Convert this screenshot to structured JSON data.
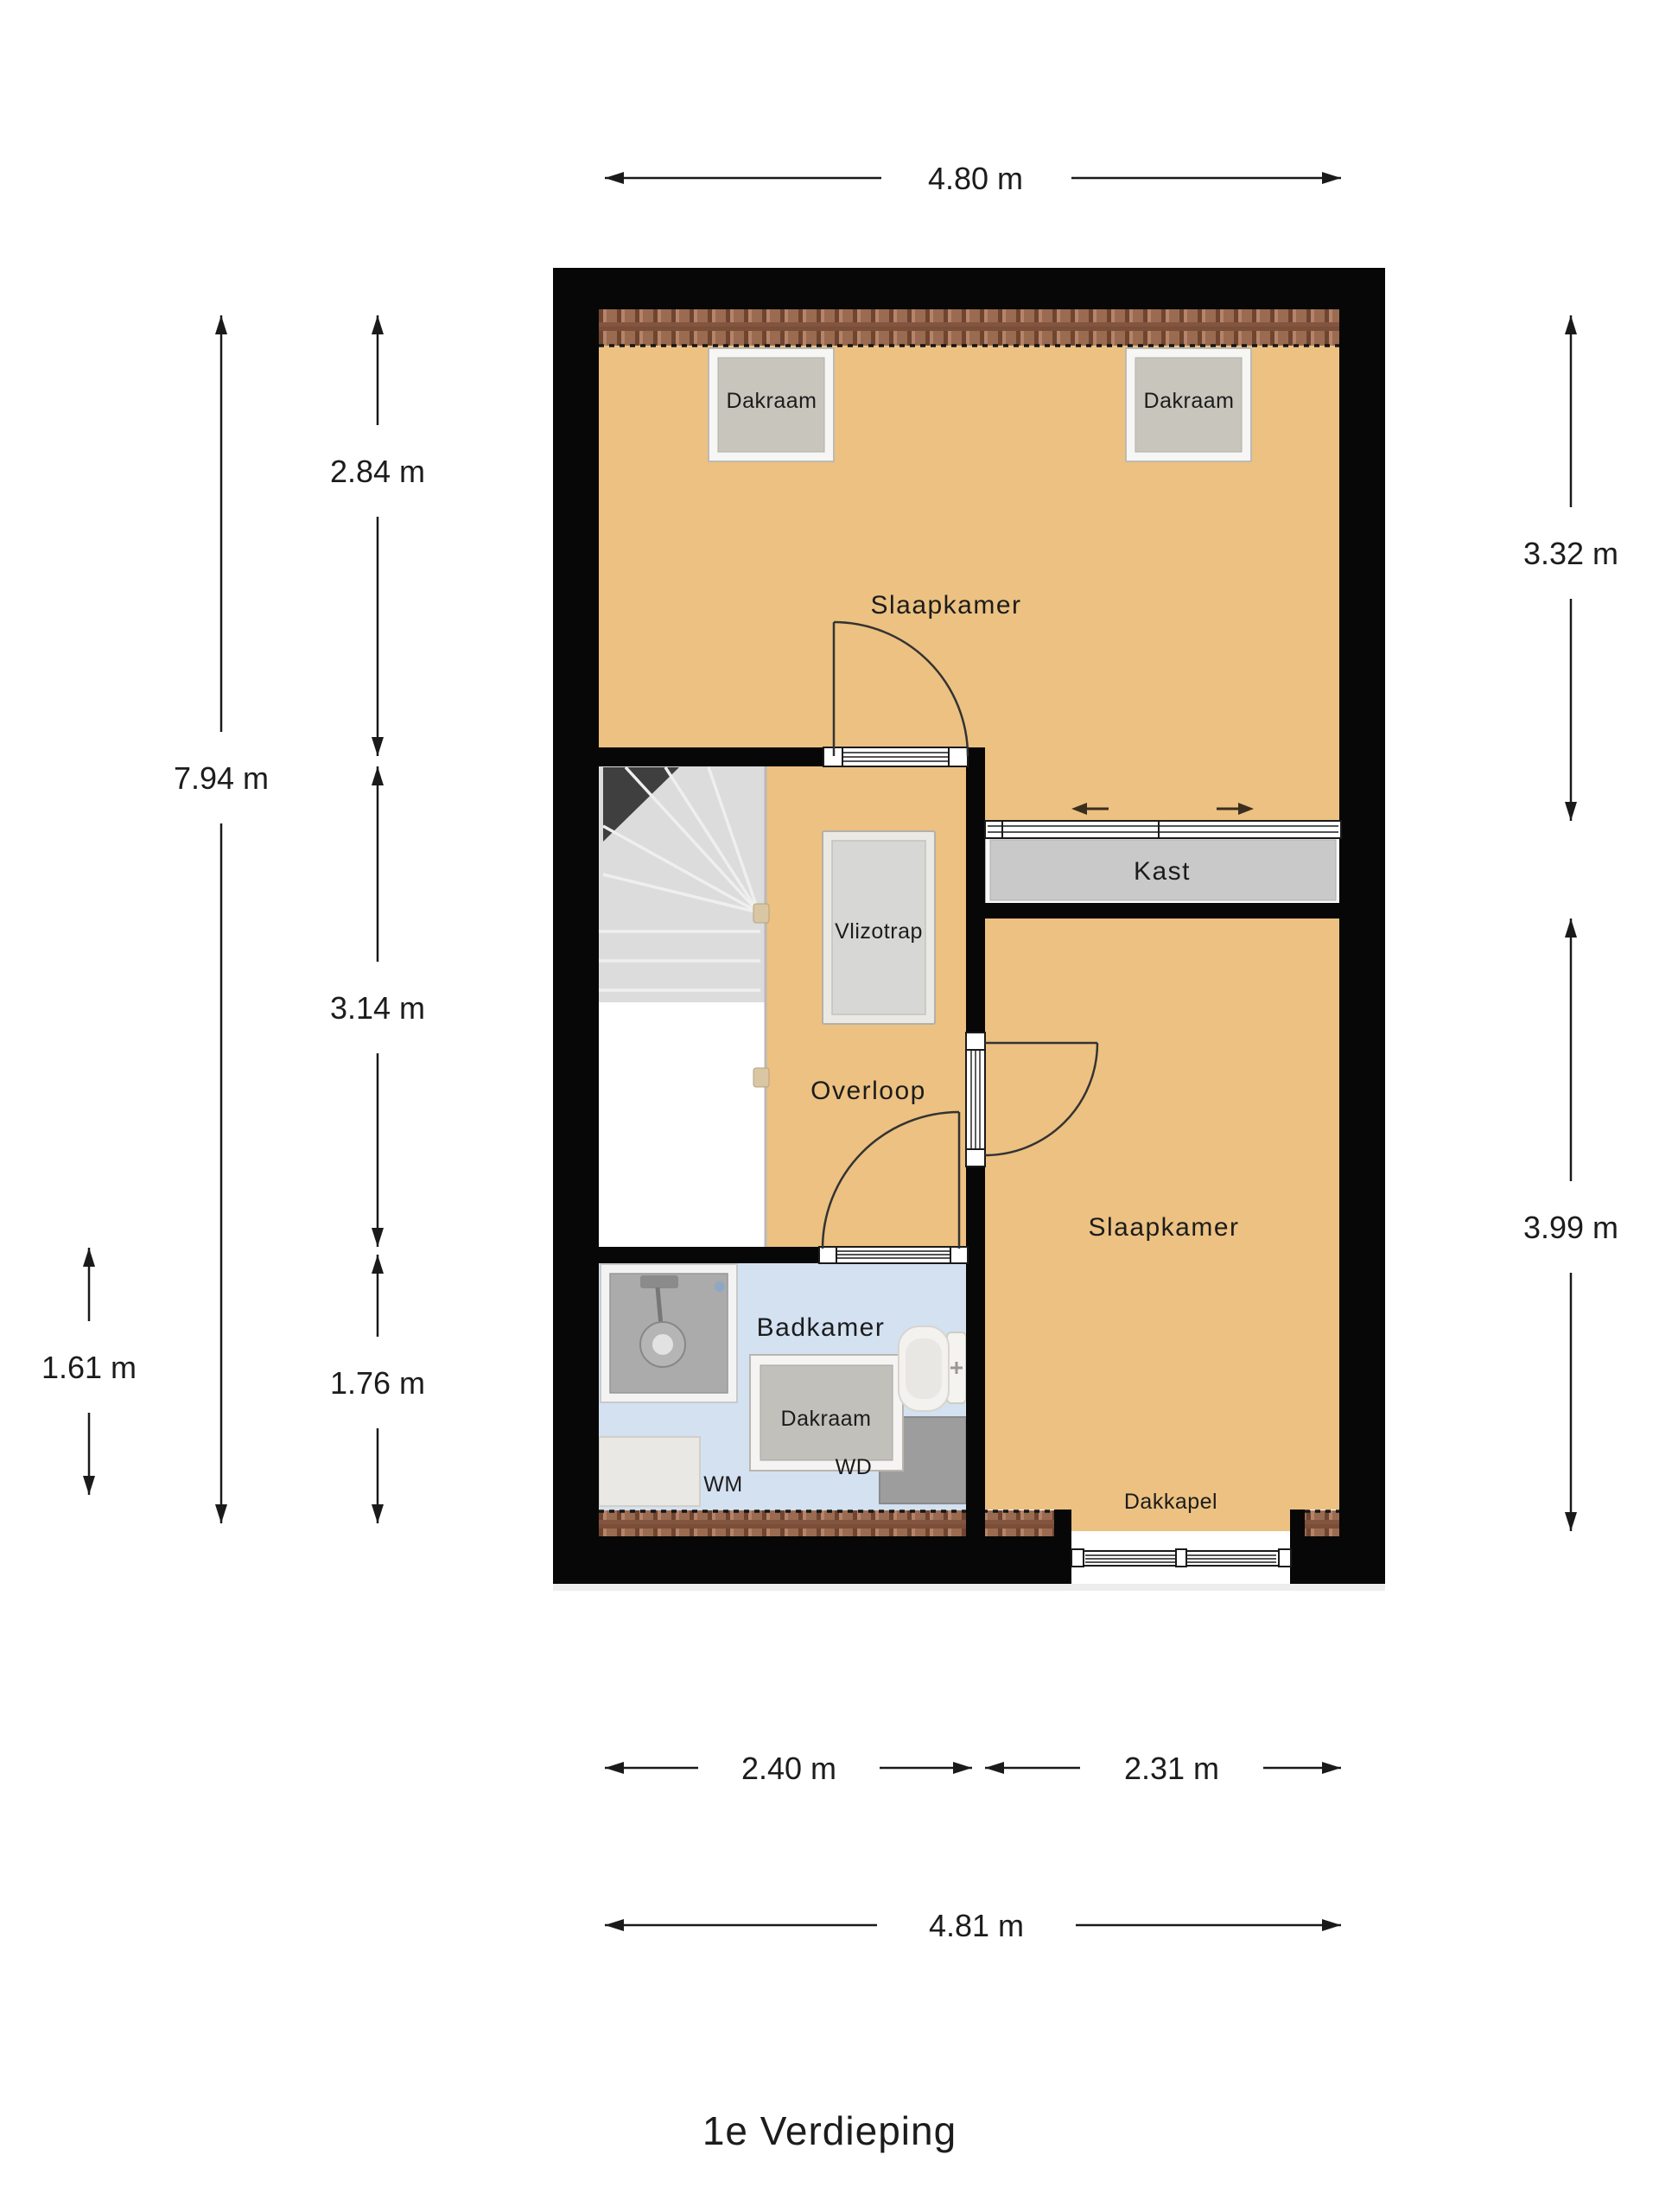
{
  "title": "1e Verdieping",
  "rooms": {
    "bedroom_top": "Slaapkamer",
    "bedroom_right": "Slaapkamer",
    "landing": "Overloop",
    "bathroom": "Badkamer",
    "closet": "Kast"
  },
  "features": {
    "roof_window": "Dakraam",
    "loft_ladder": "Vlizotrap",
    "dormer": "Dakkapel",
    "washing_machine": "WM",
    "dryer": "WD"
  },
  "dimensions": {
    "top_width": "4.80 m",
    "left_height_total": "7.94 m",
    "left_height_top": "2.84 m",
    "left_height_middle": "3.14 m",
    "left_height_bottom": "1.76 m",
    "outer_left_height": "1.61 m",
    "right_height_top": "3.32 m",
    "right_height_bottom": "3.99 m",
    "bottom_width_left": "2.40 m",
    "bottom_width_right": "2.31 m",
    "bottom_width_total": "4.81 m"
  },
  "colors": {
    "wall": "#070707",
    "floor": "#ecc181",
    "bathroom_floor": "#d3e1f1",
    "closet_fill": "#c9c9c9",
    "stairs": "#dcdcdc",
    "tile_base": "#9b6b51"
  }
}
